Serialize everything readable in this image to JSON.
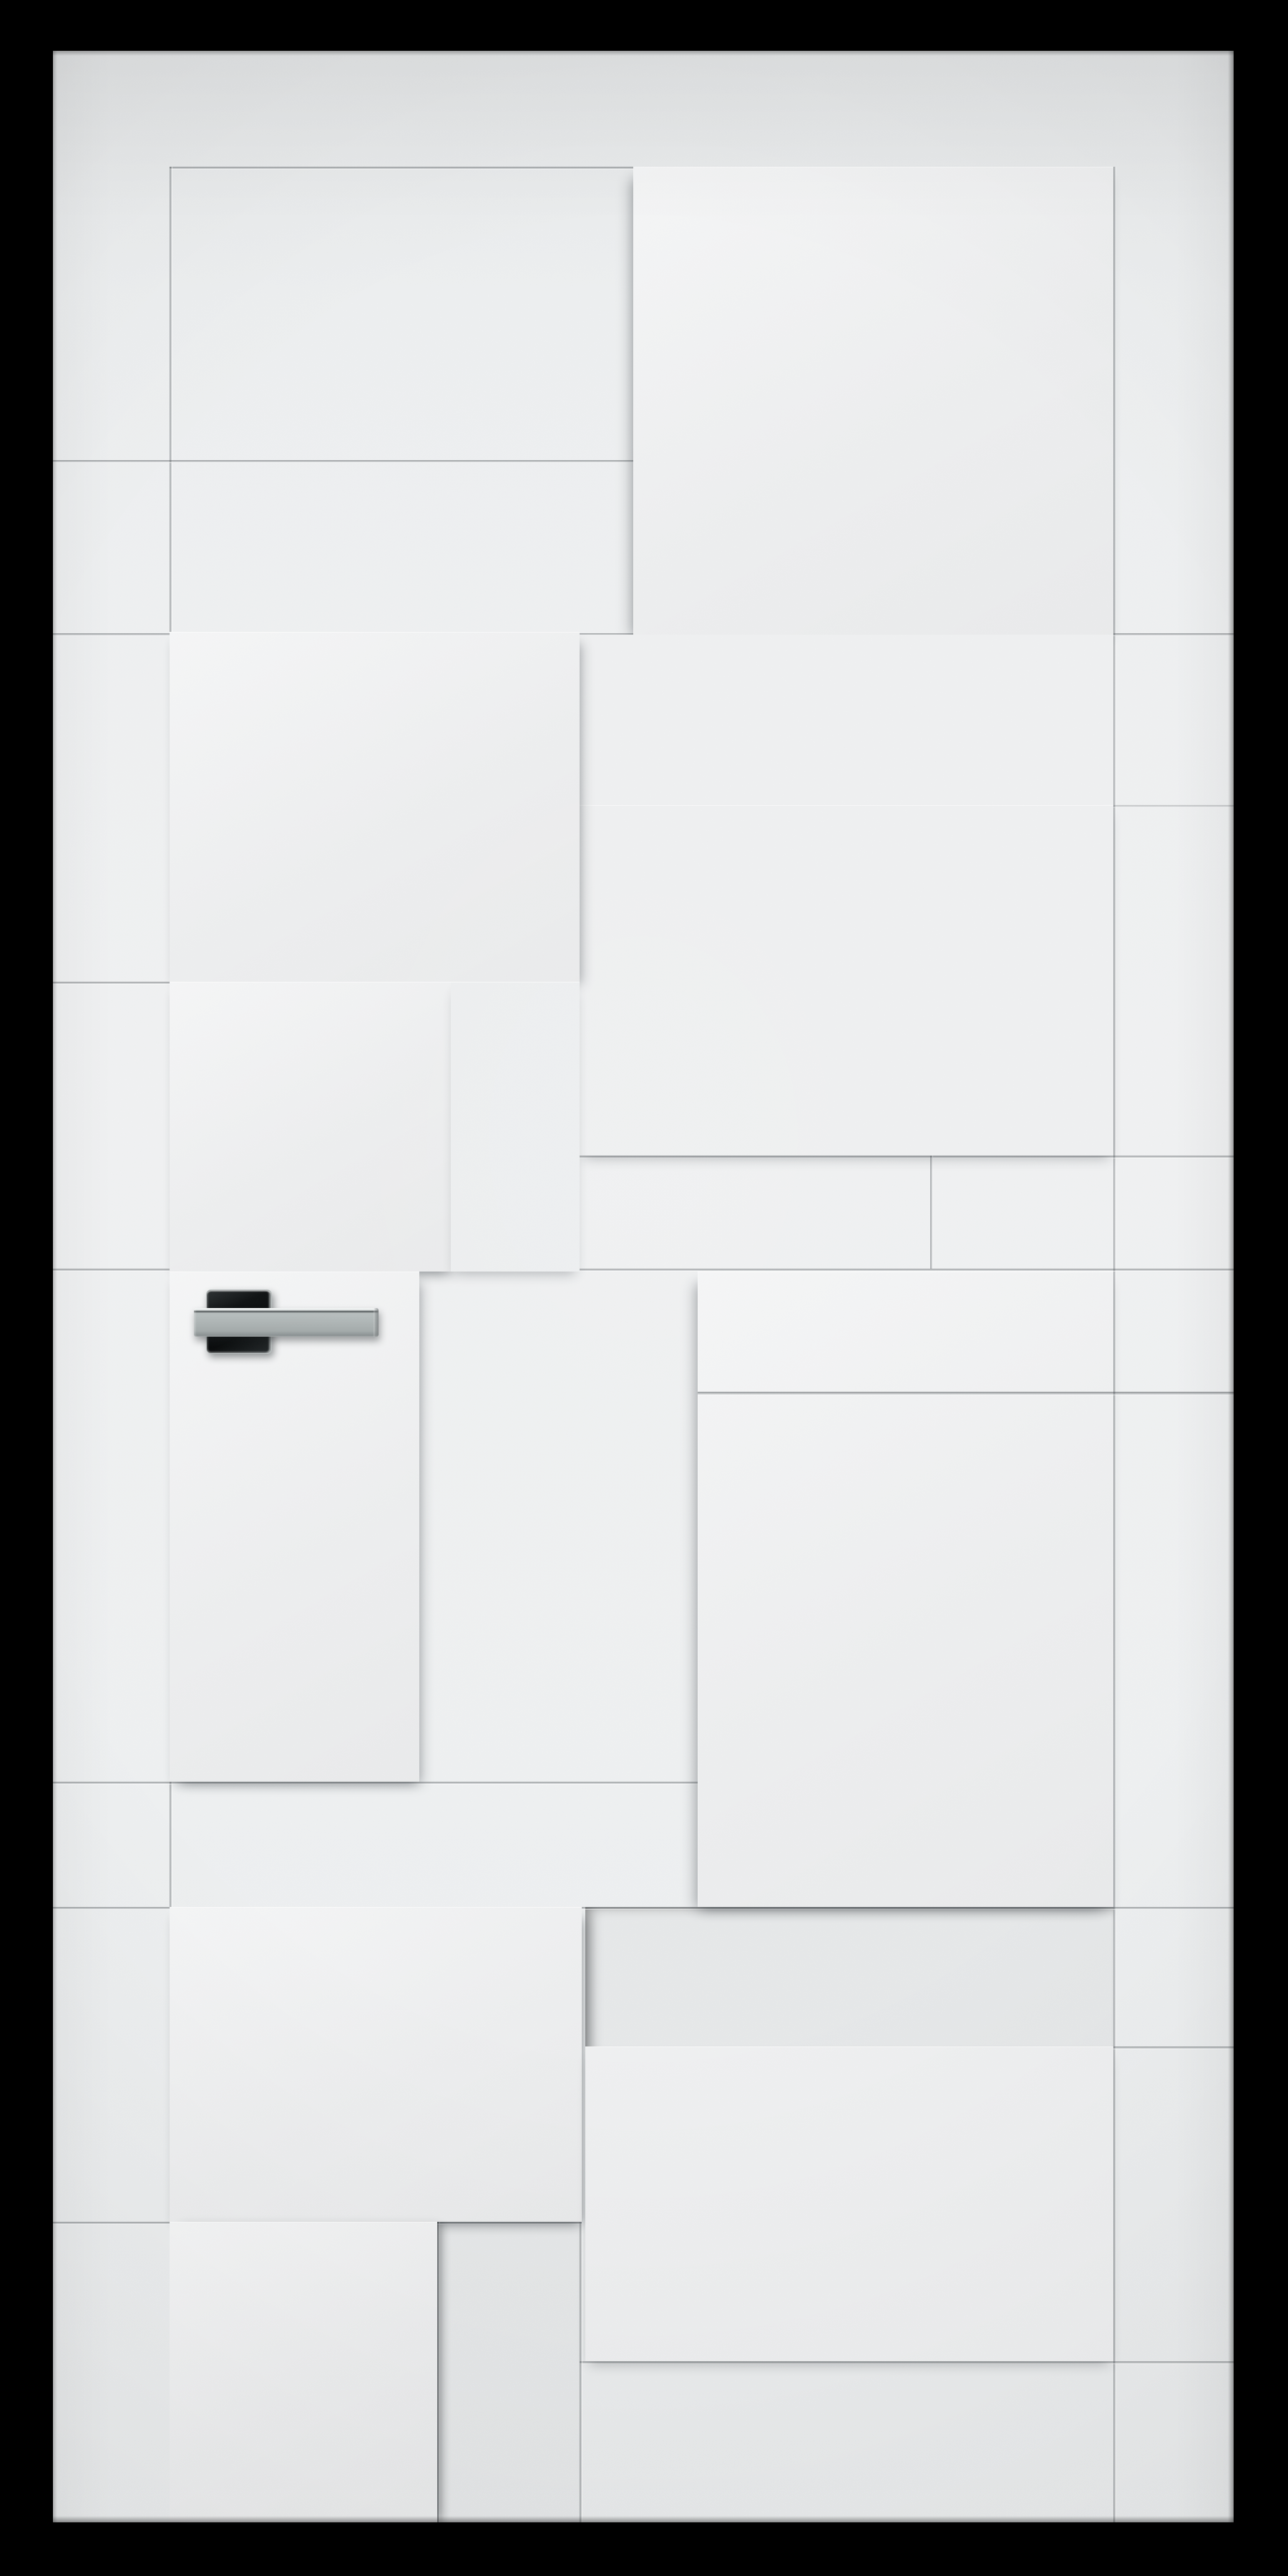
{
  "scene": {
    "type": "3d-product-render",
    "subject": "Modern white interior door with staggered geometric relief panels",
    "door_finish": "matte white, rectangular raised and recessed panel blocks in a staggered grid",
    "handle_finish": "polished chrome lever handle on a black square rosette, mounted mid-left",
    "background": "solid black",
    "door_aria": "White interior door with geometric 3D relief panels and a chrome lever handle on a black square rosette, centered on a black background",
    "handle_aria": "Chrome lever door handle with black square rosette"
  },
  "colors": {
    "frame-black": "#000000",
    "door-base": "#ebedee",
    "panel-raised": "#f1f2f3",
    "panel-mid": "#eff0f1",
    "panel-dim": "#edeff0",
    "panel-recessed": "#e6e8e9",
    "groove-dark": "#878d90",
    "groove-light": "#d6dadb",
    "shadow-soft": "rgba(45,50,55,0.32)",
    "handle-rosette-black": "#0a0d0e",
    "chrome-edge": "#d3d8d8",
    "chrome-light": "#e9eded",
    "chrome-mid": "#a9b0b0",
    "chrome-dark": "#7b8283"
  }
}
